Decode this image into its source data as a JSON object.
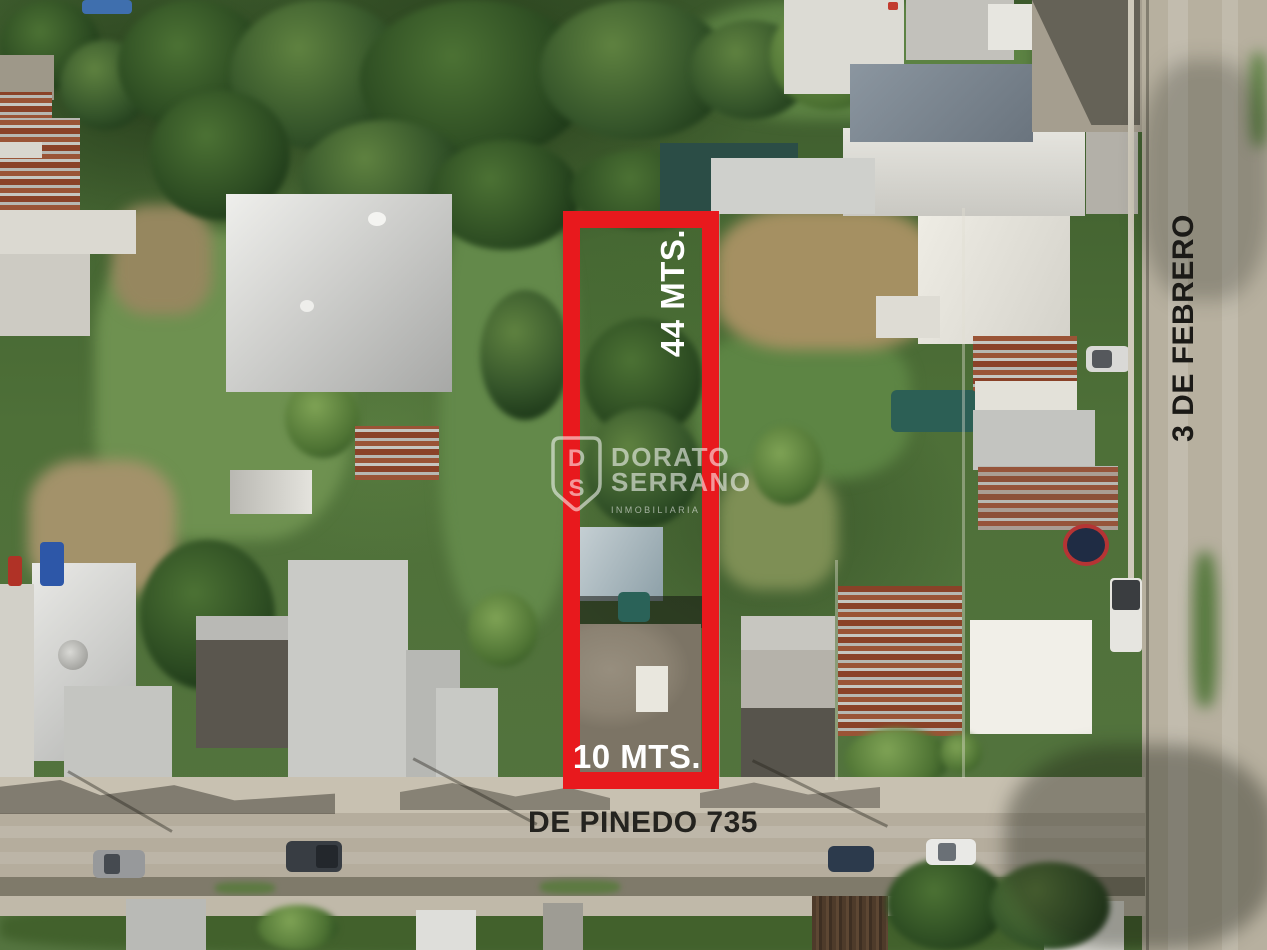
{
  "annotations": {
    "accent_red": "#e8191d",
    "label_light_color": "#ffffff",
    "front_street_color": "#24231f",
    "side_street_color": "#1b1a17",
    "depth_label": "44 MTS.",
    "frontage_label": "10 MTS.",
    "front_street_label": "DE PINEDO 735",
    "side_street_label": "3 DE FEBRERO"
  },
  "watermark": {
    "monogram_top": "D",
    "monogram_bottom": "S",
    "name_line1": "DORATO",
    "name_line2": "SERRANO",
    "tagline": "INMOBILIARIA",
    "color": "#ffffff"
  }
}
